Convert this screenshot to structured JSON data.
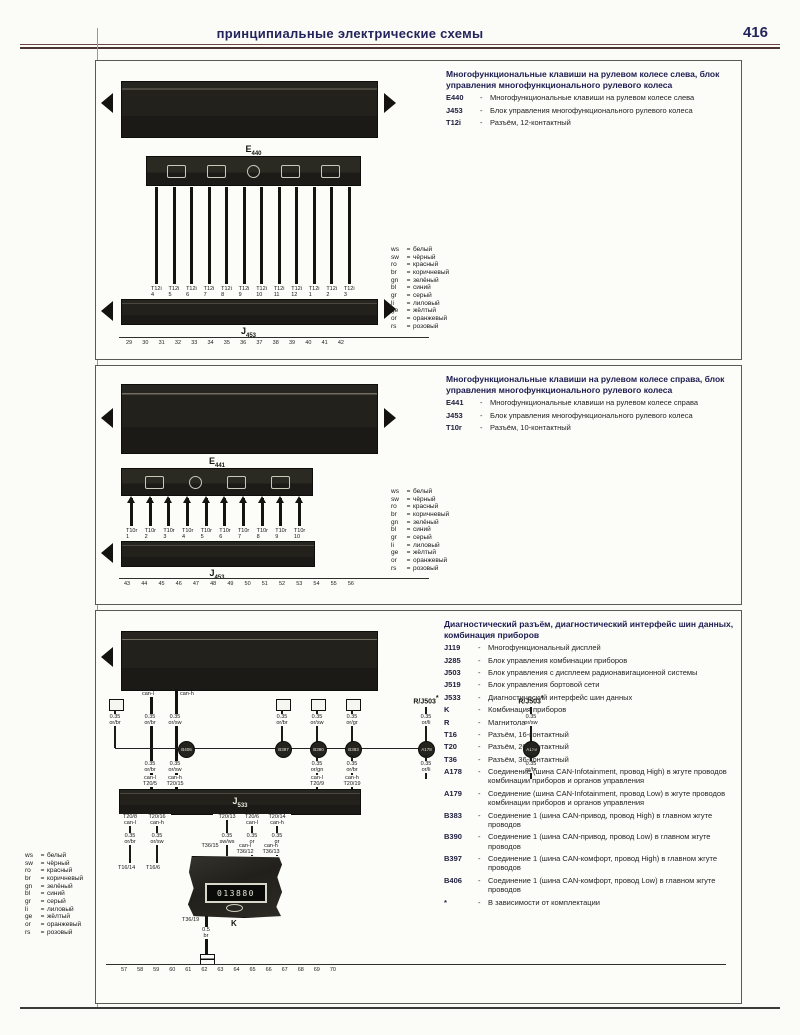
{
  "page": {
    "header_title": "принципиальные электрические схемы",
    "page_number": "416"
  },
  "glyphs": {
    "dash": "-",
    "eq": "=",
    "star": "*"
  },
  "wire_colors": [
    {
      "code": "ws",
      "name": "белый"
    },
    {
      "code": "sw",
      "name": "чёрный"
    },
    {
      "code": "ro",
      "name": "красный"
    },
    {
      "code": "br",
      "name": "коричневый"
    },
    {
      "code": "gn",
      "name": "зелёный"
    },
    {
      "code": "bl",
      "name": "синий"
    },
    {
      "code": "gr",
      "name": "серый"
    },
    {
      "code": "li",
      "name": "лиловый"
    },
    {
      "code": "ge",
      "name": "жёлтый"
    },
    {
      "code": "or",
      "name": "оранжевый"
    },
    {
      "code": "rs",
      "name": "розовый"
    }
  ],
  "panel1": {
    "title": "Многофункциональные клавиши на рулевом колесе слева, блок управления многофункционального рулевого колеса",
    "legend": [
      {
        "term": "E440",
        "desc": "Многофункциональные клавиши на рулевом колесе слева"
      },
      {
        "term": "J453",
        "desc": "Блок управления многофункционального рулевого колеса"
      },
      {
        "term": "T12i",
        "desc": "Разъём, 12-контактный"
      }
    ],
    "top_component": {
      "letter": "E",
      "sub": "440"
    },
    "bottom_component": {
      "letter": "J",
      "sub": "453"
    },
    "wires": {
      "conn": "T12i",
      "pins": [
        "4",
        "5",
        "6",
        "7",
        "8",
        "9",
        "10",
        "11",
        "12",
        "1",
        "2",
        "3"
      ]
    },
    "tracks": [
      "29",
      "30",
      "31",
      "32",
      "33",
      "34",
      "35",
      "36",
      "37",
      "38",
      "39",
      "40",
      "41",
      "42"
    ]
  },
  "panel2": {
    "title": "Многофункциональные клавиши на рулевом колесе справа, блок управления многофункционального рулевого колеса",
    "legend": [
      {
        "term": "E441",
        "desc": "Многофункциональные клавиши на рулевом колесе справа"
      },
      {
        "term": "J453",
        "desc": "Блок управления многофункционального рулевого колеса"
      },
      {
        "term": "T10r",
        "desc": "Разъём, 10-контактный"
      }
    ],
    "top_component": {
      "letter": "E",
      "sub": "441"
    },
    "bottom_component": {
      "letter": "J",
      "sub": "453"
    },
    "wires": {
      "conn": "T10r",
      "pins": [
        "1",
        "2",
        "3",
        "4",
        "5",
        "6",
        "7",
        "8",
        "9",
        "10"
      ]
    },
    "tracks": [
      "43",
      "44",
      "45",
      "46",
      "47",
      "48",
      "49",
      "50",
      "51",
      "52",
      "53",
      "54",
      "55",
      "56"
    ]
  },
  "panel3": {
    "title": "Диагностический разъём, диагностический интерфейс шин данных, комбинация приборов",
    "legend": [
      {
        "term": "J119",
        "desc": "Многофункциональный дисплей"
      },
      {
        "term": "J285",
        "desc": "Блок управления комбинации приборов"
      },
      {
        "term": "J503",
        "desc": "Блок управления с дисплеем радионавигационной системы"
      },
      {
        "term": "J519",
        "desc": "Блок управления бортовой сети"
      },
      {
        "term": "J533",
        "desc": "Диагностический интерфейс шин данных"
      },
      {
        "term": "K",
        "desc": "Комбинация приборов"
      },
      {
        "term": "R",
        "desc": "Магнитола"
      },
      {
        "term": "T16",
        "desc": "Разъём, 16-контактный"
      },
      {
        "term": "T20",
        "desc": "Разъём, 20-контактный"
      },
      {
        "term": "T36",
        "desc": "Разъём, 36-контактный"
      },
      {
        "term": "A178",
        "desc": "Соединение (шина CAN-Infotainment, провод High) в жгуте проводов комбинации приборов и органов управления"
      },
      {
        "term": "A179",
        "desc": "Соединение (шина CAN-Infotainment, провод Low) в жгуте проводов комбинации приборов и органов управления"
      },
      {
        "term": "B383",
        "desc": "Соединение 1 (шина CAN-привод, провод High) в главном жгуте проводов"
      },
      {
        "term": "B390",
        "desc": "Соединение 1 (шина CAN-привод, провод Low) в главном жгуте проводов"
      },
      {
        "term": "B397",
        "desc": "Соединение 1 (шина CAN-комфорт, провод High) в главном жгуте проводов"
      },
      {
        "term": "B406",
        "desc": "Соединение 1 (шина CAN-комфорт, провод Low) в главном жгуте проводов"
      },
      {
        "term": "*",
        "desc": "В зависимости от комплектации"
      }
    ],
    "diagram": {
      "can_labels": [
        "can-l",
        "can-h"
      ],
      "rj503": "R/J503",
      "junctions": [
        "B406",
        "B397",
        "B390",
        "B383",
        "A178",
        "A179"
      ],
      "gauges_top": [
        {
          "s": "0.35",
          "c": "or/br"
        },
        {
          "s": "0.35",
          "c": "or/br"
        },
        {
          "s": "0.35",
          "c": "or/sw"
        },
        {
          "s": "0.35",
          "c": "or/br"
        },
        {
          "s": "0.35",
          "c": "or/sw"
        },
        {
          "s": "0.35",
          "c": "or/gr"
        },
        {
          "s": "0.35",
          "c": "or/li"
        },
        {
          "s": "0.35",
          "c": "or/sw"
        }
      ],
      "gauges_mid": [
        {
          "s": "0.35",
          "c": "or/br"
        },
        {
          "s": "0.35",
          "c": "or/sw"
        },
        {
          "s": "0.35",
          "c": "or/gn"
        },
        {
          "s": "0.35",
          "c": "or/br"
        },
        {
          "s": "0.35",
          "c": "or/li"
        },
        {
          "s": "0.35",
          "c": "or/br"
        }
      ],
      "t20_top": [
        {
          "a": "can-l",
          "b": "T20/5"
        },
        {
          "a": "can-h",
          "b": "T20/15"
        },
        {
          "a": "can-l",
          "b": "T20/9"
        },
        {
          "a": "can-h",
          "b": "T20/19"
        }
      ],
      "gateway": {
        "letter": "J",
        "sub": "533"
      },
      "t20_bottom": [
        {
          "a": "T20/8",
          "b": "can-l"
        },
        {
          "a": "T20/16",
          "b": "can-h"
        },
        {
          "a": "T20/13",
          "b": ""
        },
        {
          "a": "T20/6",
          "b": "can-l"
        },
        {
          "a": "T20/14",
          "b": "can-h"
        }
      ],
      "gauges_bottom": [
        {
          "s": "0.35",
          "c": "or/br"
        },
        {
          "s": "0.35",
          "c": "or/sw"
        },
        {
          "s": "0.35",
          "c": "sw/ws"
        },
        {
          "s": "0.35",
          "c": "or"
        },
        {
          "s": "0.35",
          "c": "gr"
        }
      ],
      "t16_ends": [
        "T16/14",
        "T16/6"
      ],
      "k_top": [
        {
          "a": "",
          "b": "T36/15"
        },
        {
          "a": "can-l",
          "b": "T36/12"
        },
        {
          "a": "can-h",
          "b": "T36/13"
        }
      ],
      "cluster": {
        "label": "K",
        "pin_label": "T36/19",
        "display": "013880"
      },
      "ground": {
        "s": "0.5",
        "c": "br"
      }
    },
    "tracks": [
      "57",
      "58",
      "59",
      "60",
      "61",
      "62",
      "63",
      "64",
      "65",
      "66",
      "67",
      "68",
      "69",
      "70"
    ]
  }
}
